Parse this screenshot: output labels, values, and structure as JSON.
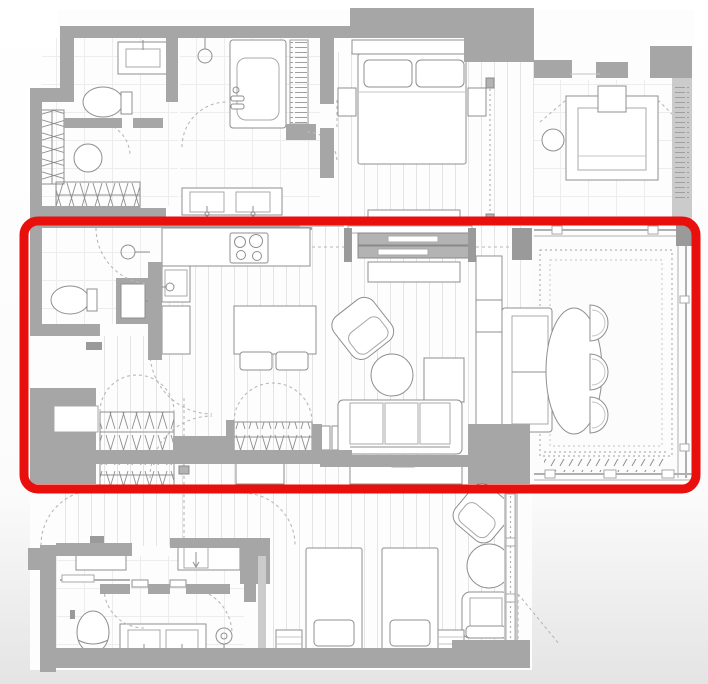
{
  "page": {
    "background_top": "#ffffff",
    "background_bottom": "#e7e7e7"
  },
  "palette": {
    "wall": "#a6a6a6",
    "wall_light": "#cbcbcb",
    "furniture_line": "#8f8f8f",
    "floor_stripe": "#e4e4e4",
    "tile_line": "#ededed",
    "dashed_line": "#b8b8b8",
    "room_fill": "#fdfdfd"
  },
  "highlight": {
    "type": "rounded-rectangle-annotation",
    "color": "#e90f0d",
    "x": 24,
    "y": 221,
    "width": 672,
    "height": 268,
    "corner_radius": 14,
    "stroke_width": 9
  },
  "floor_plan": {
    "kind": "apartment-floor-plan",
    "rooms": [
      {
        "id": "walk-in-closet",
        "label": "Walk-in closet and WC",
        "in_highlight": false,
        "furniture": [
          "toilet",
          "wash basin",
          "hanging rail vertical",
          "hanging rail horizontal",
          "stool"
        ]
      },
      {
        "id": "master-bathroom",
        "label": "Master bathroom",
        "in_highlight": false,
        "furniture": [
          "bathtub",
          "shower head",
          "towel radiator",
          "double vanity basins"
        ]
      },
      {
        "id": "master-bedroom",
        "label": "Master bedroom",
        "in_highlight": false,
        "furniture": [
          "double bed",
          "two pillows",
          "headboard shelf",
          "two nightstands",
          "foot bench",
          "sliding partition"
        ]
      },
      {
        "id": "study",
        "label": "Study lounge",
        "in_highlight": false,
        "furniture": [
          "daybed",
          "side table"
        ]
      },
      {
        "id": "powder-room",
        "label": "Powder room",
        "in_highlight": true,
        "furniture": [
          "toilet",
          "wall basin",
          "shower head"
        ]
      },
      {
        "id": "kitchen",
        "label": "Kitchen",
        "in_highlight": true,
        "furniture": [
          "counter",
          "four-burner cooktop",
          "sink",
          "island",
          "two stools",
          "tall cabinets"
        ]
      },
      {
        "id": "hallway",
        "label": "Hallway wardrobes",
        "in_highlight": true,
        "furniture": [
          "wardrobe with hangers",
          "wardrobe with hangers",
          "wardrobe with hangers",
          "cabinet",
          "shelves"
        ]
      },
      {
        "id": "living-room",
        "label": "Living room",
        "in_highlight": true,
        "furniture": [
          "three-seat sofa",
          "armchair",
          "round coffee table",
          "side table",
          "media cabinet",
          "low console"
        ]
      },
      {
        "id": "dining-terrace",
        "label": "Glazed dining terrace",
        "in_highlight": true,
        "furniture": [
          "oval dining table",
          "three chairs",
          "bench sofa",
          "glazed enclosure"
        ]
      },
      {
        "id": "second-bedroom",
        "label": "Second bedroom",
        "in_highlight": false,
        "furniture": [
          "single bed",
          "single bed",
          "two pillows",
          "two nightstands",
          "armchair",
          "armchair",
          "round table"
        ]
      },
      {
        "id": "second-bathroom",
        "label": "Second bathroom",
        "in_highlight": false,
        "furniture": [
          "toilet",
          "double vanity basins",
          "shower head",
          "storage bench",
          "closet"
        ]
      }
    ]
  }
}
